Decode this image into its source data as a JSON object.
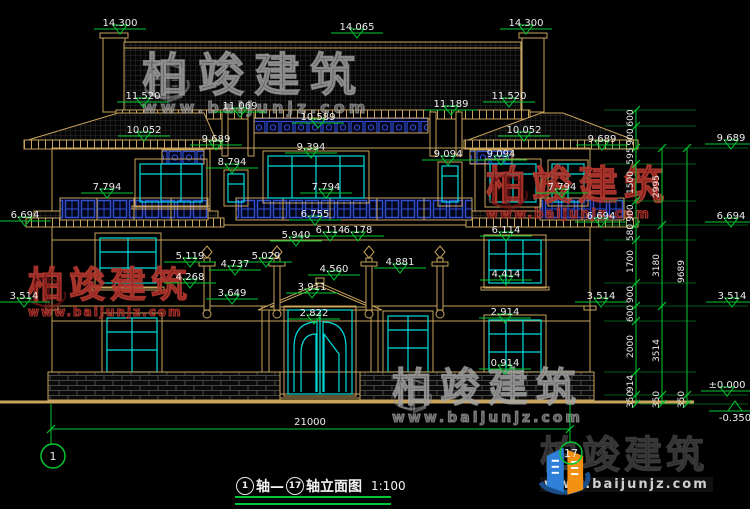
{
  "title": {
    "axis_start": "1",
    "axis_mid": "轴—",
    "axis_end": "17",
    "suffix": "轴立面图",
    "scale": "1:100"
  },
  "watermark": {
    "brand": "柏竣建筑",
    "site": "www.baijunjz.com"
  },
  "logo": {
    "brand": "柏竣建筑",
    "site": "www.baijunjz.com"
  },
  "colors": {
    "dim_green": "#00c832",
    "line_tan": "#c9a45c",
    "window_cyan": "#00dcdc",
    "lattice_blue": "#3050d8",
    "text_white": "#ededed",
    "watermark_red": "#8a2626",
    "watermark_gray": "#9a9a9a",
    "logo_blue": "#2f80d8",
    "logo_orange": "#f29111"
  },
  "annotations": {
    "elevation_markers": [
      {
        "label": "14.300",
        "x": 120,
        "y": 34
      },
      {
        "label": "14.065",
        "x": 357,
        "y": 38
      },
      {
        "label": "14.300",
        "x": 526,
        "y": 34
      },
      {
        "label": "11.520",
        "x": 143,
        "y": 107
      },
      {
        "label": "11.069",
        "x": 240,
        "y": 117
      },
      {
        "label": "10.589",
        "x": 318,
        "y": 128
      },
      {
        "label": "11.189",
        "x": 451,
        "y": 115
      },
      {
        "label": "11.520",
        "x": 509,
        "y": 107
      },
      {
        "label": "10.052",
        "x": 144,
        "y": 141
      },
      {
        "label": "10.052",
        "x": 524,
        "y": 141
      },
      {
        "label": "9.689",
        "x": 216,
        "y": 150
      },
      {
        "label": "9.689",
        "x": 602,
        "y": 150
      },
      {
        "label": "9.689",
        "x": 731,
        "y": 149
      },
      {
        "label": "9.394",
        "x": 311,
        "y": 158
      },
      {
        "label": "9.094",
        "x": 448,
        "y": 165
      },
      {
        "label": "9.094",
        "x": 501,
        "y": 165
      },
      {
        "label": "8.794",
        "x": 232,
        "y": 173
      },
      {
        "label": "7.794",
        "x": 107,
        "y": 198
      },
      {
        "label": "7.794",
        "x": 326,
        "y": 198
      },
      {
        "label": "7.794",
        "x": 562,
        "y": 198
      },
      {
        "label": "6.694",
        "x": 25,
        "y": 226
      },
      {
        "label": "6.755",
        "x": 315,
        "y": 225
      },
      {
        "label": "6.694",
        "x": 601,
        "y": 227
      },
      {
        "label": "6.694",
        "x": 731,
        "y": 227
      },
      {
        "label": "6.114",
        "x": 330,
        "y": 241
      },
      {
        "label": "6.178",
        "x": 358,
        "y": 241
      },
      {
        "label": "5.940",
        "x": 296,
        "y": 246
      },
      {
        "label": "6.114",
        "x": 506,
        "y": 241
      },
      {
        "label": "5.119",
        "x": 190,
        "y": 267
      },
      {
        "label": "5.029",
        "x": 266,
        "y": 267
      },
      {
        "label": "4.881",
        "x": 400,
        "y": 273
      },
      {
        "label": "4.737",
        "x": 235,
        "y": 275
      },
      {
        "label": "4.560",
        "x": 334,
        "y": 280
      },
      {
        "label": "4.414",
        "x": 506,
        "y": 285
      },
      {
        "label": "4.268",
        "x": 190,
        "y": 288
      },
      {
        "label": "3.911",
        "x": 312,
        "y": 298
      },
      {
        "label": "3.649",
        "x": 232,
        "y": 304
      },
      {
        "label": "3.514",
        "x": 24,
        "y": 307
      },
      {
        "label": "3.514",
        "x": 601,
        "y": 307
      },
      {
        "label": "3.514",
        "x": 732,
        "y": 307
      },
      {
        "label": "2.914",
        "x": 505,
        "y": 323
      },
      {
        "label": "2.822",
        "x": 314,
        "y": 324
      },
      {
        "label": "0.914",
        "x": 505,
        "y": 374
      },
      {
        "label": "±0.000",
        "x": 727,
        "y": 396
      },
      {
        "label": "-0.350",
        "x": 735,
        "y": 399,
        "flip": true
      }
    ],
    "dim_chains": [
      {
        "x": 636,
        "bounds": [
          110,
          126,
          148,
          164,
          201,
          225,
          240,
          283,
          306,
          321,
          372,
          395,
          404
        ],
        "segments": [
          "600",
          "900",
          "595",
          "1500",
          "900",
          "580",
          "1700",
          "900",
          "600",
          "2000",
          "914",
          "350"
        ]
      },
      {
        "x": 662,
        "bounds": [
          148,
          225,
          306,
          395,
          404
        ],
        "segments": [
          "2995",
          "3180",
          "3514",
          "350"
        ]
      },
      {
        "x": 687,
        "bounds": [
          148,
          395,
          404
        ],
        "segments": [
          "9689",
          "350"
        ]
      }
    ],
    "extension_lines": [
      {
        "y": 110,
        "x1": 604,
        "x2": 696
      },
      {
        "y": 126,
        "x1": 604,
        "x2": 696
      },
      {
        "y": 148,
        "x1": 604,
        "x2": 748
      },
      {
        "y": 164,
        "x1": 604,
        "x2": 696
      },
      {
        "y": 201,
        "x1": 604,
        "x2": 696
      },
      {
        "y": 225,
        "x1": 604,
        "x2": 748
      },
      {
        "y": 240,
        "x1": 604,
        "x2": 696
      },
      {
        "y": 283,
        "x1": 604,
        "x2": 696
      },
      {
        "y": 306,
        "x1": 604,
        "x2": 748
      },
      {
        "y": 321,
        "x1": 604,
        "x2": 696
      },
      {
        "y": 372,
        "x1": 604,
        "x2": 696
      },
      {
        "y": 395,
        "x1": 604,
        "x2": 748
      },
      {
        "y": 404,
        "x1": 640,
        "x2": 748
      }
    ],
    "overall_dim": {
      "label": "21000",
      "x1": 51,
      "x2": 570,
      "y": 429,
      "label_x": 310
    },
    "axis_bubbles": [
      {
        "label": "1",
        "x": 53,
        "y": 456,
        "r": 12,
        "leader_x": 51,
        "leader_y1": 404,
        "leader_y2": 444
      },
      {
        "label": "17",
        "x": 571,
        "y": 453,
        "r": 11,
        "leader_x": 570,
        "leader_y1": 404,
        "leader_y2": 442
      }
    ]
  }
}
